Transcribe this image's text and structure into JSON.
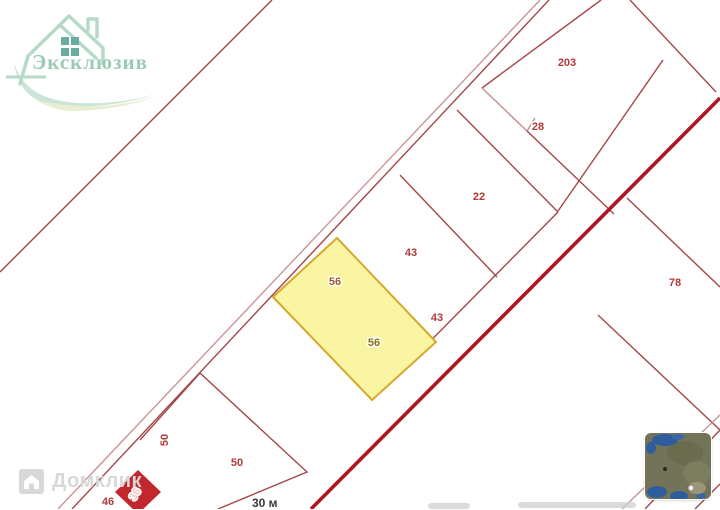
{
  "logo": {
    "brand": "Эксклюзив"
  },
  "watermark": {
    "text": "Домклик"
  },
  "scale": {
    "label": "30 м"
  },
  "layer_switcher": {
    "tooltip": "satellite-layer-thumbnail"
  },
  "map": {
    "colors": {
      "parcel_line": "#a54747",
      "street_line": "#c99596",
      "road": "#b0161f",
      "selected_fill": "#faf5a2",
      "selected_stroke": "#d6a92c",
      "label_red": "#b23a3a",
      "building_fill": "#c1272d"
    },
    "selected_parcel": {
      "number": "56"
    },
    "labels": [
      {
        "text": "203",
        "x": 567,
        "y": 66,
        "color": "#b23a3a"
      },
      {
        "text": "28",
        "x": 538,
        "y": 130,
        "color": "#b23a3a"
      },
      {
        "text": "22",
        "x": 479,
        "y": 200,
        "color": "#b23a3a"
      },
      {
        "text": "43",
        "x": 411,
        "y": 256,
        "color": "#b23a3a"
      },
      {
        "text": "43",
        "x": 437,
        "y": 321,
        "color": "#b23a3a"
      },
      {
        "text": "78",
        "x": 675,
        "y": 286,
        "color": "#b23a3a"
      },
      {
        "text": "56",
        "x": 335,
        "y": 285,
        "color": "#9b5a26"
      },
      {
        "text": "56",
        "x": 374,
        "y": 346,
        "color": "#8c6d14"
      },
      {
        "text": "50",
        "x": 168,
        "y": 440,
        "color": "#b23a3a",
        "rotate": -90
      },
      {
        "text": "50",
        "x": 237,
        "y": 466,
        "color": "#b23a3a"
      },
      {
        "text": "46",
        "x": 108,
        "y": 505,
        "color": "#b23a3a"
      },
      {
        "text": "36",
        "x": 138,
        "y": 496,
        "color": "#f0c9c9",
        "rotate": -58,
        "size": 9
      }
    ]
  }
}
